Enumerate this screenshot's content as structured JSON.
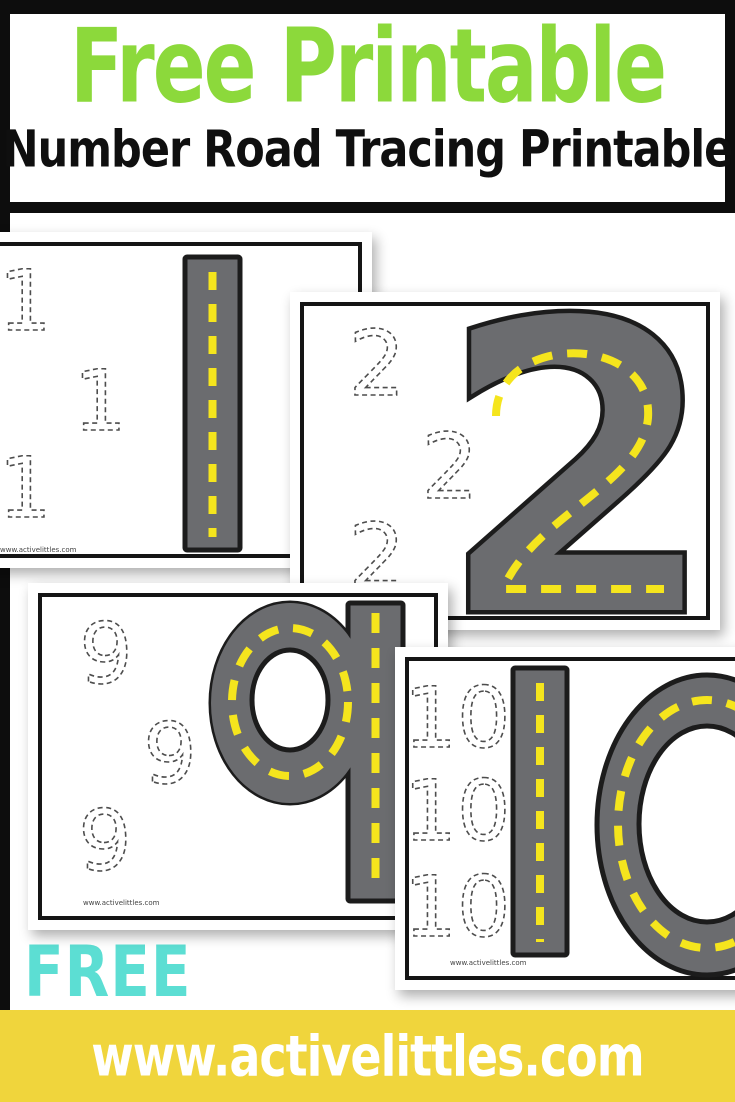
{
  "header": {
    "title": "Free Printable",
    "subtitle": "Number Road Tracing Printable"
  },
  "footer": {
    "free_label": "FREE",
    "website": "www.activelittles.com"
  },
  "colors": {
    "title_green": "#8CD93B",
    "free_teal": "#5CDED3",
    "banner_yellow": "#F0D53C",
    "road_gray": "#6B6C6F",
    "road_outline": "#1C1C1C",
    "road_dash_yellow": "#F5E51D",
    "frame_black": "#0D0D0D",
    "trace_gray": "#4D4D4D"
  },
  "cards": [
    {
      "number": "1",
      "traces": [
        "1",
        "1",
        "1"
      ],
      "watermark": "www.activelittles.com"
    },
    {
      "number": "2",
      "traces": [
        "2",
        "2",
        "2"
      ]
    },
    {
      "number": "9",
      "traces": [
        "9",
        "9",
        "9"
      ],
      "watermark": "www.activelittles.com"
    },
    {
      "number": "10",
      "traces": [
        "10",
        "10",
        "10"
      ],
      "watermark": "www.activelittles.com"
    }
  ]
}
